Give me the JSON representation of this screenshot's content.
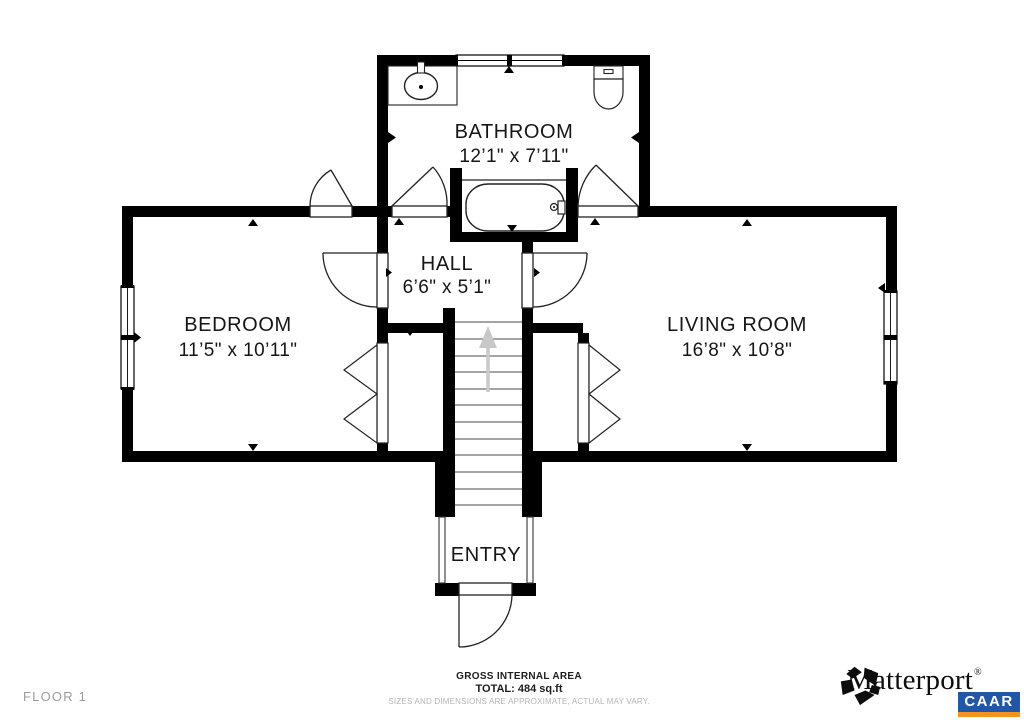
{
  "plan": {
    "floor_label": "FLOOR 1",
    "rooms": {
      "bathroom": {
        "name": "BATHROOM",
        "dims": "12’1\" x 7’11\""
      },
      "hall": {
        "name": "HALL",
        "dims": "6’6\" x 5’1\""
      },
      "bedroom": {
        "name": "BEDROOM",
        "dims": "11’5\" x 10’11\""
      },
      "living_room": {
        "name": "LIVING ROOM",
        "dims": "16’8\" x 10’8\""
      },
      "entry": {
        "name": "ENTRY"
      }
    },
    "icons": {
      "sink": "sink-icon",
      "toilet": "toilet-icon",
      "bathtub": "bathtub-icon",
      "stairs_arrow": "stairs-up-arrow-icon",
      "logo": "matterport-pinwheel-icon"
    }
  },
  "footer": {
    "area_heading": "GROSS INTERNAL AREA",
    "area_total": "TOTAL: 484 sq.ft",
    "disclaimer": "SIZES AND DIMENSIONS ARE APPROXIMATE, ACTUAL MAY VARY.",
    "brand_name": "Matterport",
    "brand_trademark": "®",
    "badge_text": "CAAR"
  },
  "colors": {
    "wall": "#000000",
    "label": "#161616",
    "muted_gray": "#9c9c9c",
    "stairs_arrow_gray": "#c8c8c8",
    "badge_blue": "#2257a8",
    "badge_orange": "#f7941e"
  }
}
